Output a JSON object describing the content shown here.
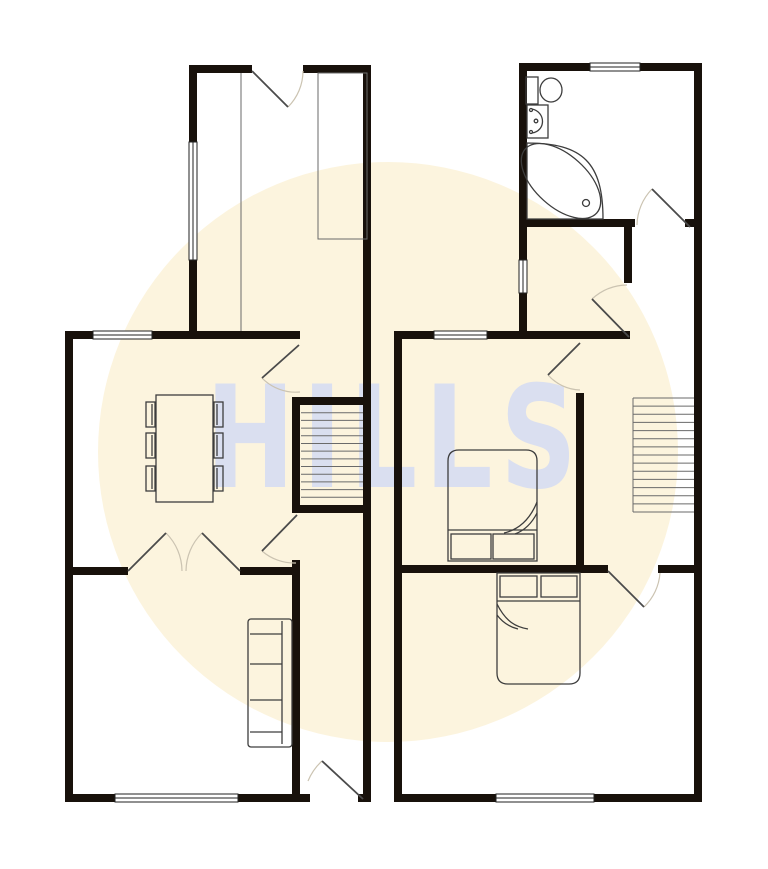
{
  "watermark": {
    "text": "HILLS",
    "circle_color": "#fcf4de",
    "text_color": "rgba(190,205,255,0.55)"
  },
  "canvas": {
    "w": 768,
    "h": 869,
    "bg": "#ffffff",
    "wall_color": "#18110b",
    "furniture_color": "#3d3d3d",
    "fine_color": "#6a6a6a",
    "door_leaf_color": "#4a4a4a",
    "door_arc_color": "#cbc3b1",
    "window_fill": "#ffffff",
    "window_stroke": "#222222"
  },
  "plans": [
    {
      "key": "ground-floor-plan",
      "walls": [
        [
          189,
          65,
          63,
          8
        ],
        [
          303,
          65,
          68,
          8
        ],
        [
          189,
          65,
          8,
          77
        ],
        [
          189,
          260,
          8,
          79
        ],
        [
          363,
          65,
          8,
          737
        ],
        [
          65,
          331,
          28,
          8
        ],
        [
          152,
          331,
          148,
          8
        ],
        [
          65,
          331,
          8,
          471
        ],
        [
          65,
          794,
          50,
          8
        ],
        [
          238,
          794,
          72,
          8
        ],
        [
          358,
          794,
          13,
          8
        ],
        [
          65,
          567,
          63,
          8
        ],
        [
          240,
          567,
          57,
          8
        ],
        [
          292,
          560,
          8,
          242
        ],
        [
          292,
          397,
          8,
          116
        ],
        [
          300,
          397,
          67,
          8
        ],
        [
          300,
          505,
          67,
          8
        ]
      ],
      "windows": [
        [
          93,
          331,
          59,
          8,
          "h"
        ],
        [
          115,
          794,
          123,
          8,
          "h"
        ],
        [
          189,
          142,
          8,
          118,
          "v"
        ]
      ],
      "doors": [
        {
          "leaf": [
            252,
            71,
            288,
            107
          ],
          "arc": "M303,71 A51,51 0 0 1 288,107"
        },
        {
          "leaf": [
            299,
            345,
            262,
            378
          ],
          "arc": "M262,378 A47,47 0 0 0 300,392"
        },
        {
          "leaf": [
            297,
            515,
            262,
            551
          ],
          "arc": "M262,551 A49,49 0 0 0 296,563"
        },
        {
          "leaf": [
            128,
            571,
            166,
            533
          ],
          "arc": "M166,533 A54,54 0 0 1 182,571"
        },
        {
          "leaf": [
            240,
            571,
            202,
            533
          ],
          "arc": "M202,533 A54,54 0 0 0 186,571"
        },
        {
          "leaf": [
            363,
            799,
            322,
            761
          ],
          "arc": "M322,761 A56,56 0 0 0 308,781"
        }
      ],
      "stairs": [
        {
          "x": 301,
          "y": 405,
          "w": 62,
          "h": 100,
          "n": 12
        }
      ],
      "furniture": [
        {
          "t": "line",
          "n": "kitchen-divider-line",
          "p": [
            241,
            73,
            241,
            331
          ],
          "sc": "#6a6a6a",
          "sw": 1
        },
        {
          "t": "rect",
          "n": "kitchen-counter",
          "x": 318,
          "y": 73,
          "w": 49,
          "h": 166,
          "sc": "#6a6a6a",
          "sw": 1
        },
        {
          "t": "rect",
          "n": "dining-table",
          "x": 156,
          "y": 395,
          "w": 57,
          "h": 107
        },
        {
          "t": "rect",
          "n": "dining-chair",
          "x": 146,
          "y": 402,
          "w": 9,
          "h": 25
        },
        {
          "t": "rect",
          "n": "dining-chair",
          "x": 146,
          "y": 433,
          "w": 9,
          "h": 25
        },
        {
          "t": "rect",
          "n": "dining-chair",
          "x": 146,
          "y": 466,
          "w": 9,
          "h": 25
        },
        {
          "t": "rect",
          "n": "dining-chair",
          "x": 214,
          "y": 402,
          "w": 9,
          "h": 25
        },
        {
          "t": "rect",
          "n": "dining-chair",
          "x": 214,
          "y": 433,
          "w": 9,
          "h": 25
        },
        {
          "t": "rect",
          "n": "dining-chair",
          "x": 214,
          "y": 466,
          "w": 9,
          "h": 25
        },
        {
          "t": "line",
          "n": "dining-chair-line",
          "p": [
            152,
            404,
            152,
            425
          ]
        },
        {
          "t": "line",
          "n": "dining-chair-line",
          "p": [
            152,
            435,
            152,
            456
          ]
        },
        {
          "t": "line",
          "n": "dining-chair-line",
          "p": [
            152,
            468,
            152,
            489
          ]
        },
        {
          "t": "line",
          "n": "dining-chair-line",
          "p": [
            217,
            404,
            217,
            425
          ]
        },
        {
          "t": "line",
          "n": "dining-chair-line",
          "p": [
            217,
            435,
            217,
            456
          ]
        },
        {
          "t": "line",
          "n": "dining-chair-line",
          "p": [
            217,
            468,
            217,
            489
          ]
        },
        {
          "t": "rect",
          "n": "sofa",
          "x": 248,
          "y": 619,
          "w": 44,
          "h": 128,
          "rx": 3
        },
        {
          "t": "line",
          "n": "sofa-back",
          "p": [
            282,
            621,
            282,
            744
          ]
        },
        {
          "t": "line",
          "n": "sofa-arm",
          "p": [
            250,
            634,
            282,
            634
          ]
        },
        {
          "t": "line",
          "n": "sofa-arm",
          "p": [
            250,
            732,
            282,
            732
          ]
        },
        {
          "t": "line",
          "n": "sofa-cushion",
          "p": [
            250,
            664,
            282,
            664
          ]
        },
        {
          "t": "line",
          "n": "sofa-cushion",
          "p": [
            250,
            700,
            282,
            700
          ]
        }
      ]
    },
    {
      "key": "first-floor-plan",
      "walls": [
        [
          519,
          63,
          71,
          8
        ],
        [
          640,
          63,
          62,
          8
        ],
        [
          519,
          63,
          8,
          197
        ],
        [
          519,
          293,
          8,
          46
        ],
        [
          694,
          63,
          8,
          739
        ],
        [
          519,
          219,
          116,
          8
        ],
        [
          685,
          219,
          9,
          8
        ],
        [
          624,
          227,
          8,
          56
        ],
        [
          394,
          331,
          40,
          8
        ],
        [
          487,
          331,
          143,
          8
        ],
        [
          394,
          331,
          8,
          471
        ],
        [
          394,
          794,
          102,
          8
        ],
        [
          594,
          794,
          108,
          8
        ],
        [
          576,
          393,
          8,
          180
        ],
        [
          402,
          565,
          206,
          8
        ],
        [
          658,
          565,
          44,
          8
        ]
      ],
      "windows": [
        [
          590,
          63,
          50,
          8,
          "h"
        ],
        [
          434,
          331,
          53,
          8,
          "h"
        ],
        [
          496,
          794,
          98,
          8,
          "h"
        ],
        [
          519,
          260,
          8,
          33,
          "v"
        ]
      ],
      "doors": [
        {
          "leaf": [
            690,
            227,
            652,
            189
          ],
          "arc": "M652,189 A53,53 0 0 0 637,225"
        },
        {
          "leaf": [
            629,
            337,
            592,
            299
          ],
          "arc": "M592,299 A53,53 0 0 1 627,285"
        },
        {
          "leaf": [
            580,
            343,
            548,
            375
          ],
          "arc": "M548,375 A45,45 0 0 0 580,390"
        },
        {
          "leaf": [
            608,
            571,
            644,
            607
          ],
          "arc": "M644,607 A52,52 0 0 0 660,573"
        }
      ],
      "stairs": [
        {
          "x": 633,
          "y": 398,
          "w": 61,
          "h": 114,
          "n": 13
        }
      ],
      "furniture": [
        {
          "t": "line",
          "n": "stairs-edge",
          "p": [
            633,
            398,
            633,
            512
          ],
          "sc": "#6a6a6a",
          "sw": 1
        },
        {
          "t": "line",
          "n": "stairs-edge",
          "p": [
            633,
            398,
            694,
            398
          ],
          "sc": "#6a6a6a",
          "sw": 1
        },
        {
          "t": "line",
          "n": "stairs-edge",
          "p": [
            633,
            512,
            694,
            512
          ],
          "sc": "#6a6a6a",
          "sw": 1
        },
        {
          "t": "rect",
          "n": "toilet-cistern",
          "x": 526,
          "y": 77,
          "w": 12,
          "h": 27
        },
        {
          "t": "ell",
          "n": "toilet-bowl",
          "cx": 551,
          "cy": 90,
          "rx": 11,
          "ry": 12,
          "rot": 0
        },
        {
          "t": "rect",
          "n": "sink",
          "x": 527,
          "y": 105,
          "w": 21,
          "h": 33
        },
        {
          "t": "path",
          "n": "sink-basin",
          "d": "M532,109 C546,112 546,131 532,133"
        },
        {
          "t": "dot",
          "n": "sink-tap",
          "cx": 531,
          "cy": 110,
          "r": 1.5
        },
        {
          "t": "dot",
          "n": "sink-tap",
          "cx": 531,
          "cy": 132,
          "r": 1.5
        },
        {
          "t": "dot",
          "n": "sink-drain",
          "cx": 536,
          "cy": 121,
          "r": 1.8
        },
        {
          "t": "path",
          "n": "bath",
          "d": "M527,143 C583,143 603,163 603,219 L527,219 Z"
        },
        {
          "t": "ell",
          "n": "bath-tub",
          "cx": 561,
          "cy": 181,
          "rx": 48,
          "ry": 26,
          "rot": 42
        },
        {
          "t": "dot",
          "n": "bath-drain",
          "cx": 586,
          "cy": 203,
          "r": 3.5
        },
        {
          "t": "path",
          "n": "bed",
          "d": "M448,561 L448,461 Q448,450 459,450 L526,450 Q537,450 537,461 L537,561 Z"
        },
        {
          "t": "line",
          "n": "bed-sheet-line",
          "p": [
            448,
            530,
            537,
            530
          ]
        },
        {
          "t": "rect",
          "n": "bed-pillow",
          "x": 451,
          "y": 534,
          "w": 40,
          "h": 25
        },
        {
          "t": "rect",
          "n": "bed-pillow",
          "x": 493,
          "y": 534,
          "w": 41,
          "h": 25
        },
        {
          "t": "path",
          "n": "bed-fold",
          "d": "M537,502 C529,522 517,530 504,533"
        },
        {
          "t": "path",
          "n": "bed-fold",
          "d": "M537,513 C531,525 523,531 515,534"
        },
        {
          "t": "path",
          "n": "bed",
          "d": "M497,573 L497,673 Q497,684 508,684 L569,684 Q580,684 580,673 L580,573 Z"
        },
        {
          "t": "line",
          "n": "bed-sheet-line",
          "p": [
            497,
            601,
            580,
            601
          ]
        },
        {
          "t": "rect",
          "n": "bed-pillow",
          "x": 500,
          "y": 576,
          "w": 37,
          "h": 21
        },
        {
          "t": "rect",
          "n": "bed-pillow",
          "x": 541,
          "y": 576,
          "w": 36,
          "h": 21
        },
        {
          "t": "path",
          "n": "bed-fold",
          "d": "M497,604 C506,622 516,627 528,629"
        },
        {
          "t": "path",
          "n": "bed-fold",
          "d": "M497,615 C503,623 510,627 518,629"
        }
      ]
    }
  ]
}
